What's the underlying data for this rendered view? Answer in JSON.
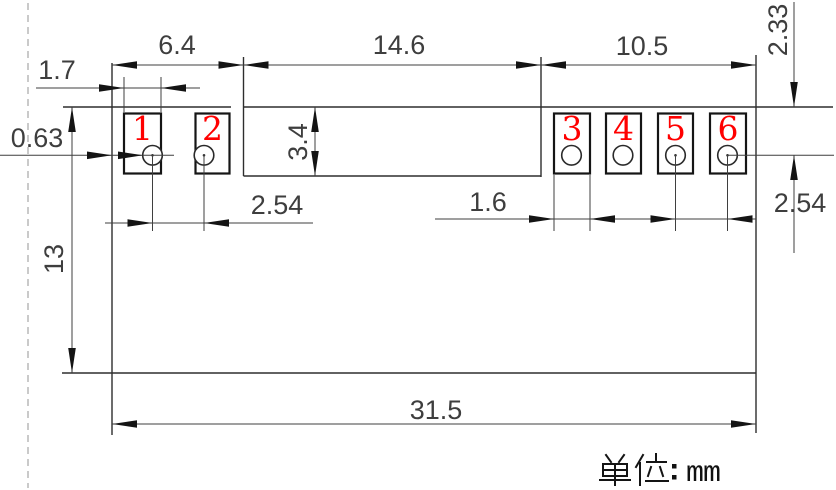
{
  "drawing": {
    "type": "footprint-dimension-drawing",
    "pads": [
      {
        "number": "1"
      },
      {
        "number": "2"
      },
      {
        "number": "3"
      },
      {
        "number": "4"
      },
      {
        "number": "5"
      },
      {
        "number": "6"
      }
    ],
    "dims": {
      "left_pad_width": "1.7",
      "left_section_width": "6.4",
      "middle_section_width": "14.6",
      "right_section_width": "10.5",
      "edge_to_pad_gap": "0.63",
      "middle_height": "3.4",
      "top_to_hole_center": "2.33",
      "body_height": "13",
      "left_hole_pitch": "2.54",
      "right_pad_width": "1.6",
      "right_hole_pitch": "2.54",
      "total_width": "31.5"
    },
    "note": {
      "unit_label": "单位：",
      "unit_value": "mm"
    },
    "colors": {
      "pad_number_red": "#ff0000",
      "line_gray": "#3f3f3f",
      "centerline_gray": "#b3b3b3"
    }
  }
}
